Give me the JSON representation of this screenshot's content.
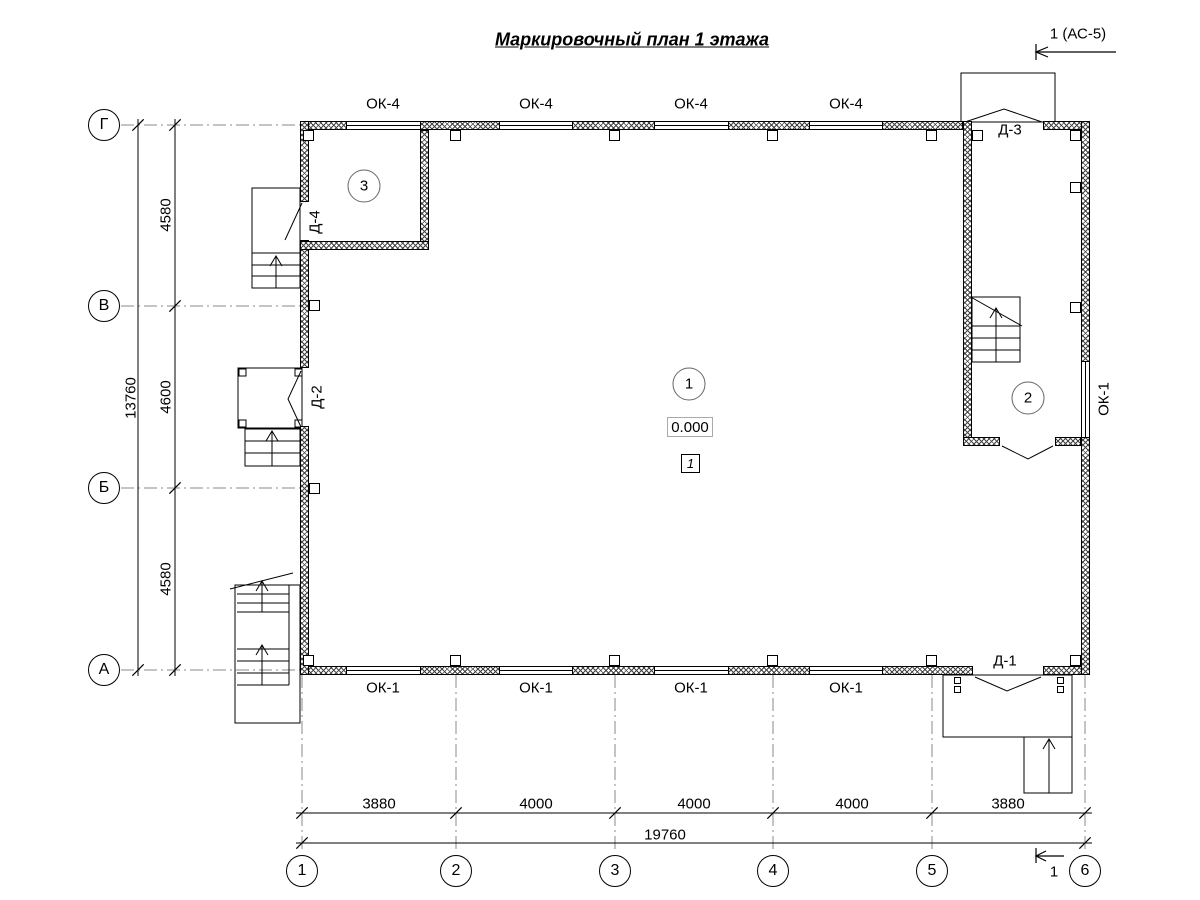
{
  "title": "Маркировочный план 1 этажа",
  "section_marks": {
    "top": "1 (АС-5)",
    "bottom": "1"
  },
  "axes": {
    "rows": [
      "Г",
      "В",
      "Б",
      "А"
    ],
    "cols": [
      "1",
      "2",
      "3",
      "4",
      "5",
      "6"
    ]
  },
  "dimensions": {
    "left_segments": [
      "4580",
      "4600",
      "4580"
    ],
    "left_total": "13760",
    "bottom_segments": [
      "3880",
      "4000",
      "4000",
      "4000",
      "3880"
    ],
    "bottom_total": "19760"
  },
  "windows": {
    "top": [
      "ОК-4",
      "ОК-4",
      "ОК-4",
      "ОК-4"
    ],
    "bottom": [
      "ОК-1",
      "ОК-1",
      "ОК-1",
      "ОК-1"
    ],
    "right": "ОК-1"
  },
  "doors": {
    "d1": "Д-1",
    "d2": "Д-2",
    "d3": "Д-3",
    "d4": "Д-4"
  },
  "rooms": {
    "hall": "1",
    "stair_room": "2",
    "corner_room": "3"
  },
  "elevation": "0.000",
  "plan_note": "1",
  "colors": {
    "line": "#000000",
    "grid": "#888888",
    "background": "#ffffff"
  }
}
